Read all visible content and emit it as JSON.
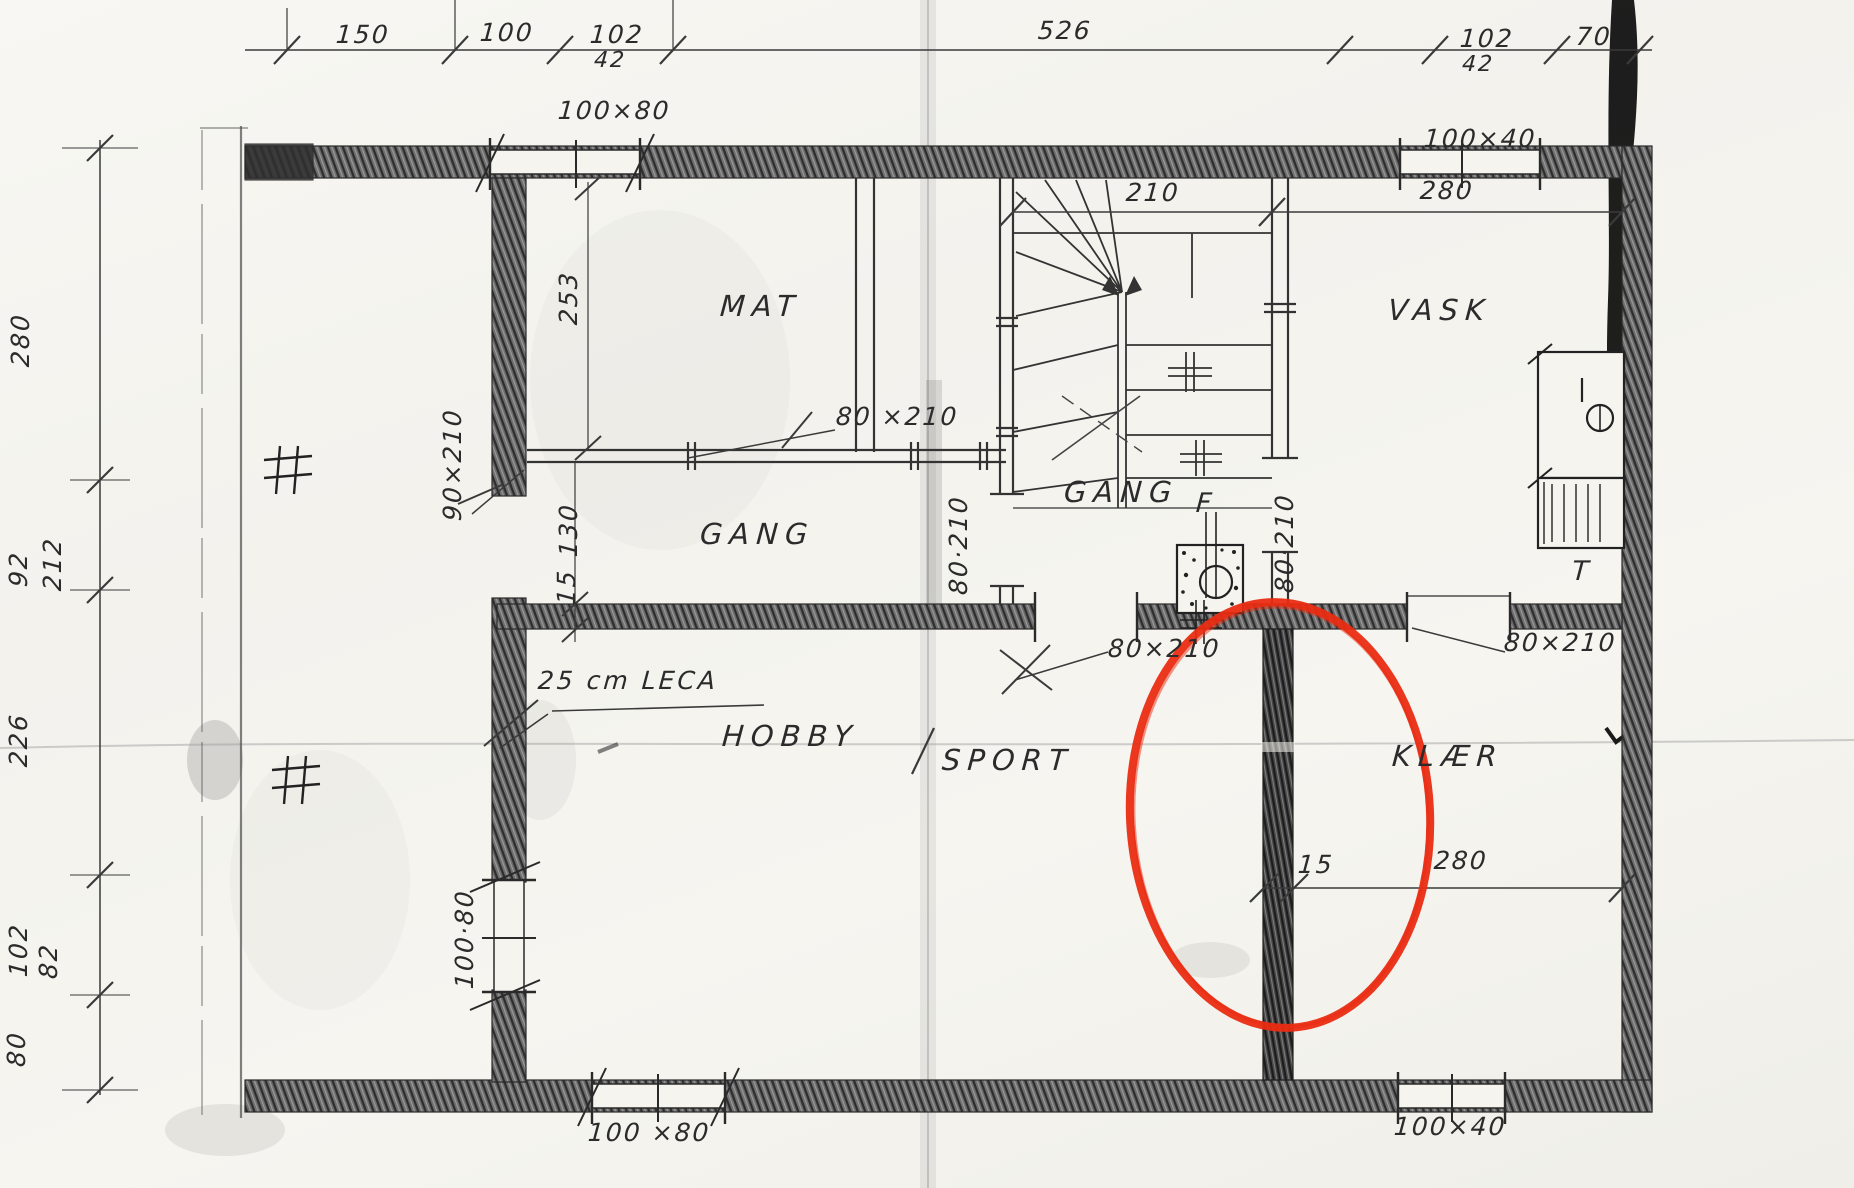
{
  "title": "Basement floor plan – pencil sketch with red highlight",
  "labels": {
    "top_150": "150",
    "top_100": "100",
    "top_102a": "102",
    "top_42a": "42",
    "top_526": "526",
    "top_102b": "102",
    "top_42b": "42",
    "top_70": "70",
    "left_280": "280",
    "left_92": "92",
    "left_212": "212",
    "left_226": "226",
    "left_102": "102",
    "left_82": "82",
    "left_80": "80",
    "win_top_left": "100×80",
    "win_top_right": "100×40",
    "win_bottom_left": "100 ×80",
    "win_bottom_right": "100×40",
    "win_left_rot": "100·80",
    "stair_width": "210",
    "vask_width": "280",
    "room_mat": "MAT",
    "room_vask": "VASK",
    "room_gang_left": "GANG",
    "room_gang_center": "GANG",
    "room_hobby": "HOBBY",
    "room_sport": "SPORT",
    "room_klaer": "KLÆR",
    "dim_mat_253": "253",
    "dim_gang_130": "130",
    "dim_wall_15": "15",
    "note_leca": "25 cm LECA",
    "door_mat": "80 ×210",
    "door_gang_rot": "80·210",
    "door_vask_rot": "80·210",
    "door_hobby": "80×210",
    "door_klaer": "80×210",
    "door_left": "90×210",
    "chimney_f": "F",
    "t_mark": "T",
    "klaer_wall_15": "15",
    "klaer_width_280": "280"
  },
  "colors": {
    "paper": "#f5f4ef",
    "pencil": "#2b2b2b",
    "wall_shade": "#5a5a5a",
    "highlight_red": "#e92c12",
    "tape_mark": "#0d0d0d"
  }
}
